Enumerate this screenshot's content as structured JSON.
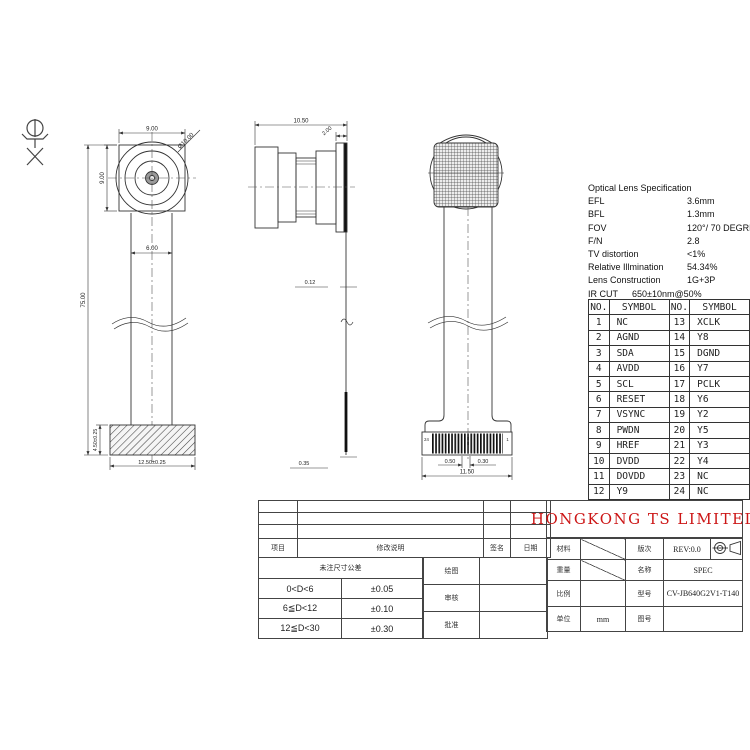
{
  "colors": {
    "accent_red": "#cc1616",
    "line": "#333333"
  },
  "spec": {
    "title": "Optical Lens Specification",
    "rows": [
      {
        "label": "EFL",
        "value": "3.6mm"
      },
      {
        "label": "BFL",
        "value": "1.3mm"
      },
      {
        "label": "FOV",
        "value": "120°/ 70 DEGREE"
      },
      {
        "label": "F/N",
        "value": "2.8"
      },
      {
        "label": "TV distortion",
        "value": "<1%"
      },
      {
        "label": "Relative Illmination",
        "value": "54.34%"
      },
      {
        "label": "Lens Construction",
        "value": "1G+3P"
      },
      {
        "label": "IR CUT",
        "value": "650±10nm@50%"
      }
    ]
  },
  "pin_table": {
    "headers": [
      "NO.",
      "SYMBOL",
      "NO.",
      "SYMBOL"
    ],
    "rows": [
      [
        "1",
        "NC",
        "13",
        "XCLK"
      ],
      [
        "2",
        "AGND",
        "14",
        "Y8"
      ],
      [
        "3",
        "SDA",
        "15",
        "DGND"
      ],
      [
        "4",
        "AVDD",
        "16",
        "Y7"
      ],
      [
        "5",
        "SCL",
        "17",
        "PCLK"
      ],
      [
        "6",
        "RESET",
        "18",
        "Y6"
      ],
      [
        "7",
        "VSYNC",
        "19",
        "Y2"
      ],
      [
        "8",
        "PWDN",
        "20",
        "Y5"
      ],
      [
        "9",
        "HREF",
        "21",
        "Y3"
      ],
      [
        "10",
        "DVDD",
        "22",
        "Y4"
      ],
      [
        "11",
        "DOVDD",
        "23",
        "NC"
      ],
      [
        "12",
        "Y9",
        "24",
        "NC"
      ]
    ]
  },
  "drawings": {
    "front": {
      "dim_top": "9.00",
      "dim_left": "9.00",
      "dim_diameter": "Ø10.00",
      "dim_cable": "6.00",
      "dim_total": "75.00",
      "dim_conn_h": "4.50±0.25",
      "dim_conn_w": "12.50±0.25"
    },
    "side": {
      "dim_total": "10.50",
      "dim_head": "2.00",
      "dim_fpc": "0.12",
      "dim_stiffener": "0.35"
    },
    "rear": {
      "pin_last": "24",
      "pin_first": "1",
      "dim_pitch_a": "0.50",
      "dim_pitch_b": "0.30",
      "dim_width": "11.50"
    }
  },
  "revision_table": {
    "headers": [
      "项目",
      "修改说明",
      "签名",
      "日期"
    ]
  },
  "tolerance_table": {
    "title": "未注尺寸公差",
    "rows": [
      [
        "0<D<6",
        "±0.05"
      ],
      [
        "6≦D<12",
        "±0.10"
      ],
      [
        "12≦D<30",
        "±0.30"
      ]
    ]
  },
  "approval": {
    "rows": [
      "绘图",
      "审核",
      "批准"
    ]
  },
  "title_block": {
    "company": "HONGKONG TS LIMITED",
    "material_label": "材料",
    "revision_label": "版次",
    "revision_value": "REV:0.0",
    "weight_label": "重量",
    "name_label": "名称",
    "name_value": "SPEC",
    "scale_label": "比例",
    "model_label": "型号",
    "model_value": "CV-JB640G2V1-T140",
    "unit_label": "单位",
    "unit_value": "mm",
    "drawing_no_label": "图号"
  }
}
